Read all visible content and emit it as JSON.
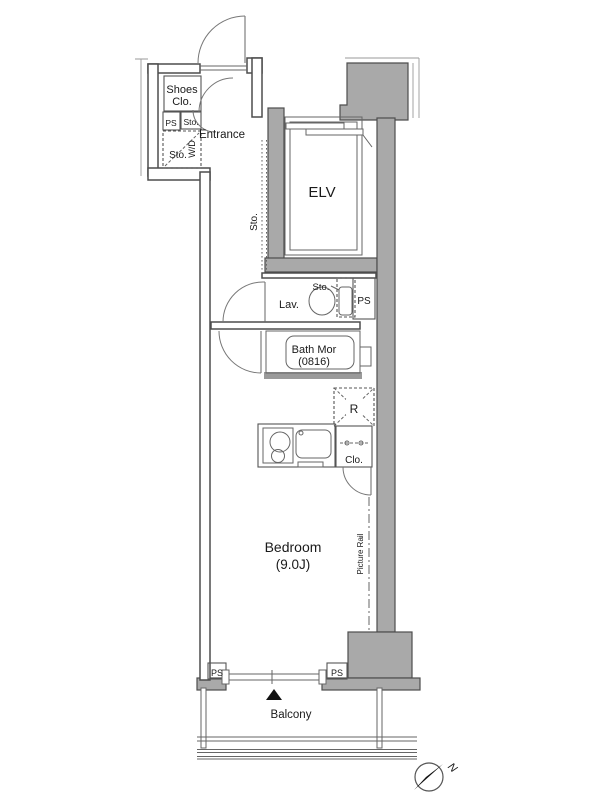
{
  "floorplan": {
    "labels": {
      "shoes_1": "Shoes",
      "shoes_2": "Clo.",
      "ps_entry": "PS",
      "sto_entry": "Sto.",
      "entrance": "Entrance",
      "sto_wd": "Sto.",
      "wd": "W/D",
      "sto_corridor": "Sto.",
      "elevator": "ELV",
      "sto_lav": "Sto.",
      "lavatory": "Lav.",
      "ps_lav": "PS",
      "bath_1": "Bath Mor",
      "bath_2": "(0816)",
      "fridge": "R",
      "closet": "Clo.",
      "bedroom_1": "Bedroom",
      "bedroom_2": "(9.0J)",
      "picture_rail": "Picture Rail",
      "ps_bottom_left": "PS",
      "ps_bottom_right": "PS",
      "balcony": "Balcony",
      "north": "N"
    },
    "colors": {
      "wall": "#a9a9a9",
      "wall_dark": "#9a9a9a",
      "outline": "#4d4d4d",
      "text": "#1a1a1a",
      "compass_arrow": "#111111"
    }
  }
}
